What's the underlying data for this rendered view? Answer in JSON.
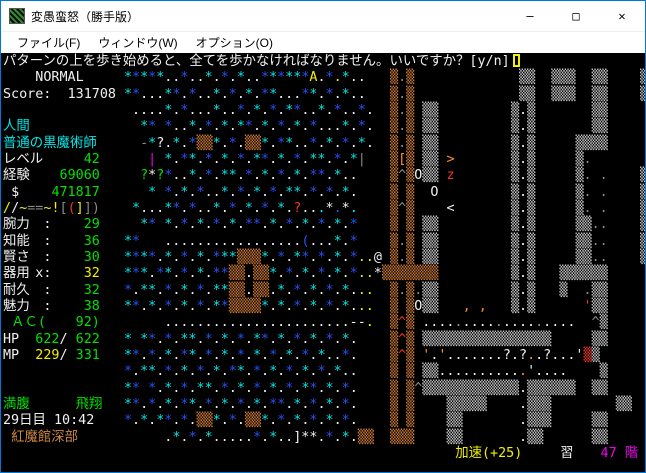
{
  "window": {
    "title": "変愚蛮怒（勝手版）",
    "controls": [
      {
        "name": "minimize-button",
        "icon": "minimize-icon",
        "glyph": "—"
      },
      {
        "name": "maximize-button",
        "icon": "maximize-icon",
        "glyph": "□"
      },
      {
        "name": "close-button",
        "icon": "close-icon",
        "glyph": "✕"
      }
    ]
  },
  "menu": {
    "items": [
      "ファイル(F)",
      "ウィンドウ(W)",
      "オプション(O)"
    ]
  },
  "palette": {
    "c": "#00e8e8",
    "b": "#2b50f5",
    "w": "#f0f0f0",
    "g": "#8a8a8a",
    "y": "#f2f200",
    "o": "#ff9020",
    "u": "#d07a32",
    "s": "#c4c4c4",
    "r": "#f03428",
    "G": "#00e000",
    "m": "#f000f0",
    "n": "#ce8640"
  },
  "message": {
    "text": "パターンの上を歩き始めると、全てを歩かなければなりません。いいですか？[y/n]",
    "color": "w",
    "has_cursor": true
  },
  "overlays": [
    {
      "row": 1,
      "col": 4,
      "text": "NORMAL",
      "color": "w"
    },
    {
      "row": 2,
      "col": 0,
      "text": "Score:",
      "color": "w"
    },
    {
      "row": 2,
      "col": 8,
      "text": "131708",
      "color": "w"
    },
    {
      "row": 4,
      "col": 0,
      "text": "人間",
      "color": "c"
    },
    {
      "row": 5,
      "col": 0,
      "text": "普通の黒魔術師",
      "color": "c"
    },
    {
      "row": 6,
      "col": 0,
      "text": "レベル",
      "color": "w"
    },
    {
      "row": 6,
      "col": 10,
      "text": "42",
      "color": "G"
    },
    {
      "row": 7,
      "col": 0,
      "text": "経験",
      "color": "w"
    },
    {
      "row": 7,
      "col": 7,
      "text": "69060",
      "color": "G"
    },
    {
      "row": 8,
      "col": 1,
      "text": "$",
      "color": "w"
    },
    {
      "row": 8,
      "col": 6,
      "text": "471817",
      "color": "G"
    },
    {
      "row": 9,
      "col": 0,
      "text": "/",
      "color": "y"
    },
    {
      "row": 9,
      "col": 1,
      "text": "/",
      "color": "w"
    },
    {
      "row": 9,
      "col": 2,
      "text": "~",
      "color": "y"
    },
    {
      "row": 9,
      "col": 3,
      "text": "==",
      "color": "g"
    },
    {
      "row": 9,
      "col": 5,
      "text": "~",
      "color": "y"
    },
    {
      "row": 9,
      "col": 6,
      "text": "!",
      "color": "y"
    },
    {
      "row": 9,
      "col": 7,
      "text": "[",
      "color": "g"
    },
    {
      "row": 9,
      "col": 8,
      "text": "(",
      "color": "r"
    },
    {
      "row": 9,
      "col": 9,
      "text": "]",
      "color": "y"
    },
    {
      "row": 9,
      "col": 10,
      "text": "]",
      "color": "g"
    },
    {
      "row": 9,
      "col": 11,
      "text": ")",
      "color": "g"
    },
    {
      "row": 10,
      "col": 0,
      "text": "腕力",
      "color": "w"
    },
    {
      "row": 10,
      "col": 5,
      "text": ":",
      "color": "w"
    },
    {
      "row": 10,
      "col": 10,
      "text": "29",
      "color": "G"
    },
    {
      "row": 11,
      "col": 0,
      "text": "知能",
      "color": "w"
    },
    {
      "row": 11,
      "col": 5,
      "text": ":",
      "color": "w"
    },
    {
      "row": 11,
      "col": 10,
      "text": "36",
      "color": "G"
    },
    {
      "row": 12,
      "col": 0,
      "text": "賢さ",
      "color": "w"
    },
    {
      "row": 12,
      "col": 5,
      "text": ":",
      "color": "w"
    },
    {
      "row": 12,
      "col": 10,
      "text": "30",
      "color": "G"
    },
    {
      "row": 13,
      "col": 0,
      "text": "器用",
      "color": "w"
    },
    {
      "row": 13,
      "col": 4,
      "text": "x",
      "color": "w"
    },
    {
      "row": 13,
      "col": 5,
      "text": ":",
      "color": "w"
    },
    {
      "row": 13,
      "col": 10,
      "text": "32",
      "color": "y"
    },
    {
      "row": 14,
      "col": 0,
      "text": "耐久",
      "color": "w"
    },
    {
      "row": 14,
      "col": 5,
      "text": ":",
      "color": "w"
    },
    {
      "row": 14,
      "col": 10,
      "text": "32",
      "color": "G"
    },
    {
      "row": 15,
      "col": 0,
      "text": "魅力",
      "color": "w"
    },
    {
      "row": 15,
      "col": 5,
      "text": ":",
      "color": "w"
    },
    {
      "row": 15,
      "col": 10,
      "text": "38",
      "color": "G"
    },
    {
      "row": 16,
      "col": 1,
      "text": "ＡＣ(",
      "color": "G"
    },
    {
      "row": 16,
      "col": 9,
      "text": "92)",
      "color": "G"
    },
    {
      "row": 17,
      "col": 0,
      "text": "HP",
      "color": "w"
    },
    {
      "row": 17,
      "col": 4,
      "text": "622",
      "color": "G"
    },
    {
      "row": 17,
      "col": 7,
      "text": "/",
      "color": "w"
    },
    {
      "row": 17,
      "col": 9,
      "text": "622",
      "color": "G"
    },
    {
      "row": 18,
      "col": 0,
      "text": "MP",
      "color": "w"
    },
    {
      "row": 18,
      "col": 4,
      "text": "229",
      "color": "y"
    },
    {
      "row": 18,
      "col": 7,
      "text": "/",
      "color": "w"
    },
    {
      "row": 18,
      "col": 9,
      "text": "331",
      "color": "G"
    },
    {
      "row": 21,
      "col": 0,
      "text": "満腹",
      "color": "G"
    },
    {
      "row": 21,
      "col": 9,
      "text": "飛翔",
      "color": "G"
    },
    {
      "row": 22,
      "col": 0,
      "text": "29日目 10:42",
      "color": "w"
    },
    {
      "row": 23,
      "col": 1,
      "text": "紅魔館深部",
      "color": "n"
    },
    {
      "row": 24,
      "col": 56,
      "text": "加速(+25)",
      "color": "y"
    },
    {
      "row": 24,
      "col": 69,
      "text": "習",
      "color": "w"
    },
    {
      "row": 24,
      "col": 74,
      "text": "47 階",
      "color": "m"
    }
  ],
  "map_rows": [
    {
      "t": "",
      "c": ""
    },
    {
      "t": "               *****..*..*.*.*..******A.*.*..   ▒.▒             ▒▒  ▒▒▒  ▒▒    ▒",
      "c": "               cbcbcwwbwwcwbwcwwbcbccbywbycww   ugu             ss  sss  ss    s"
    },
    {
      "t": "               **...**.*..*.*.*.**...**.*.*..   ▒.▒             ▒▒  ▒▒▒  ▒▒    ▒",
      "c": "               cbwwwcbwbwwcwbwcwbcwwwbcwbwcww   ugu             ss  sss  ss    s"
    },
    {
      "t": "                ....*.*...*..*.*.*.**..*.*..*.  ▒.▒ ▒▒         ▒.▒       ▒▒     ",
      "c": "                wwwwcwbwwwcwwbwcwbwcbwwcwbwwbw  ugu ss         sws       ss     "
    },
    {
      "t": "                 ** *..*.*.*.**.*.*.*.*...*.*.  ▒.▒ ▒▒         ▒.▒       ▒▒     ",
      "c": "                 cb bwwcwbwcwcbwcwbwcwbwwwcwbw  ugu ss         sws       ss     "
    },
    {
      "t": "                 -*?.*.*▒▒*.*.▒▒*.**..*.*.*.*.  ▒.▒ ▒▒         ▒.▒     ▒▒▒▒     ",
      "c": "                 gcwwcwbuucwbwuucwbcwwbwcwbwcw  ugu ss         sws     ssss     "
    },
    {
      "t": "                  | *.**.*.*.*.**.*.*.**.*.*|   ▒[▒ ▒▒ >       ▒.▒     ▒.| .    ▒",
      "c": "                  m cwbcwbwcwbwcbwcwbwccwbwcg   uou ss o       sws     sg g    s"
    },
    {
      "t": "                 ?*?*..*.*.**.*.*.*.*.**.*..    ▒^▒O▒▒ z       ▒.▒     ▒. .    ▒",
      "c": "                 GwGbwwcwbwccwbwcwbwcwbbwcww    uguwss r       sws     sg g    s"
    },
    {
      "t": "                  * *.*.*..*.*.*.*.**.*.*.*.    ▒ ▒  O         ▒.▒     ▒. .    ▒",
      "c": "                  c bwcwbwwcwbwcwbwccwbwbwcw    u u  w         sws     sg g    s"
    },
    {
      "t": "                *...**.*..*.*.*.*.*.?...*.*.    ▒^▒    <       ▒.▒     ▒. .    ▒",
      "c": "                cwwwcbwbwwcwbwcwbwcwrwwcwbwc    ugu    w       sws     sg g    s"
    },
    {
      "t": "                 ** *.*.*.*.*.**.*.*.*.*.*.*    ▒ ▒ ▒▒         ▒.▒     ▒▒..    ▒",
      "c": "                 cb cwbwcwbwcwbbwcwbwcwbwcwb    u u ss         sws     ssgg    s"
    },
    {
      "t": "               **   .................(...*.*    ▒.▒ ▒▒         ▒.▒     ▒▒..    ▒",
      "c": "               cb   wwwwwwwwwwwwwwwwwbwwwcwb    ugu ss         sws     ssgg    s"
    },
    {
      "t": "               ****.*.*.*.***▒▒▒*.*.**.*.*.*..@ ▒.▒ ▒▒         ▒.▒     ▒▒..    ▒",
      "c": "               cbcbwcwbwcwbccuuucwbwcbwbwcwbyyw ugu ss         sws     ssgg    s"
    },
    {
      "t": "               ***.**.*.*.**▒▒.▒▒*.*.*.*.*.*..*▒▒▒▒▒▒▒         ▒.▒   ▒▒▒▒▒▒     ",
      "c": "               cbcwbcwbwcwbbuuwuucwbwcwbwcwbyywuuuuuuu         sws   ssssss     "
    },
    {
      "t": "               *.**.*.*.*.**▒▒.▒▒.*.*.*.*.*...  ▒.▒.▒▒         ▒.▒   ▒  .▒▒     ",
      "c": "               bwccwbwcwbwccuuwuuwcwbwcwbwcwyy  ugugss         sws   s  gss     "
    },
    {
      "t": "               **.*.*.*.*.**▒▒▒▒*.*.*.*.*.*...  ▒ ▒O▒▒   , ,   ▒.▒      '▒▒     ",
      "c": "               cbwcwbwcwbwcbuuuucwcwbwcwbwcwyy  u uwss   o o   sws      rss     "
    },
    {
      "t": "                    .......................--.  ▒^▒ ...................  ^▒     ",
      "c": "                    wwwwwwwwwwwwwwwwwwwwwwwwwy  uru wwwwgwwwwgwwwwgwwww  gs     "
    },
    {
      "t": "               * **.*.**.*.*.*.**.*.*.*.*.*.    ▒^▒ ▒▒▒▒▒▒▒▒▒▒▒▒▒▒▒▒     ▒▒     ",
      "c": "               c cbwbwccwbwcwbwcbwcwbwcwbwcw    uru ssssssssssssssss     ss     "
    },
    {
      "t": "               **.*.*.**.*.*.*.*.*.*.*.*..*.    ▒^▒ '.'.......?.?..?...'▒▒     ",
      "c": "               cbwbwcwbcwbwcwbwcwbwcwbwcwwbw    uru owowwwwwwwwwwowwwwwwrss     "
    },
    {
      "t": "               *.**.*.*.*.*.**.*.*.*.*.*.*..    ▒ ▒ ▒▒...........'.....   ▒▒     ",
      "c": "               bwccwbwcwbwcwbcwbwcwbwcwbwcww    u u sswwwwwwwwwwowwwww   ss     "
    },
    {
      "t": "               ** *.*.*.**.*.*.*.*.*.**.*.*.    ▒ ▒^▒▒▒▒▒▒▒▒▒▒▒▒.▒▒▒▒▒▒  ▒▒     ",
      "c": "               cb bwcwbwccwbwcwbwcwbwcbwcwbw    u ugsssssssssssswssssss  ss     "
    },
    {
      "t": "               **.*.*.**.*.*.*.*.**.*.*.*.*.    ▒ ▒    ▒▒▒▒▒    .▒▒▒        ▒▒     ",
      "c": "               cbwbwcwbcwbwcwbwcwbbwcwbwcwbw    u u    sssss    wsss        ss     "
    },
    {
      "t": "               *.*.**.*.▒▒*.*.▒▒*.*.*.*.*.*.    ▒ ▒    ▒▒       .▒▒▒     ▒▒     ",
      "c": "               bwcwcbwbwuucwbwuucwbwcwbwcwbw    u u    ss       wsss     ss     "
    },
    {
      "t": "                    .*.*.*.....*.*..]**.*.*.▒▒  ▒▒▒    ▒▒       .▒▒      ▒▒     ",
      "c": "                    wcwbwcwwwwwbwcwwwwwwbwcwuu  uuu    ss       wss      ss     "
    },
    {
      "t": "",
      "c": ""
    }
  ]
}
